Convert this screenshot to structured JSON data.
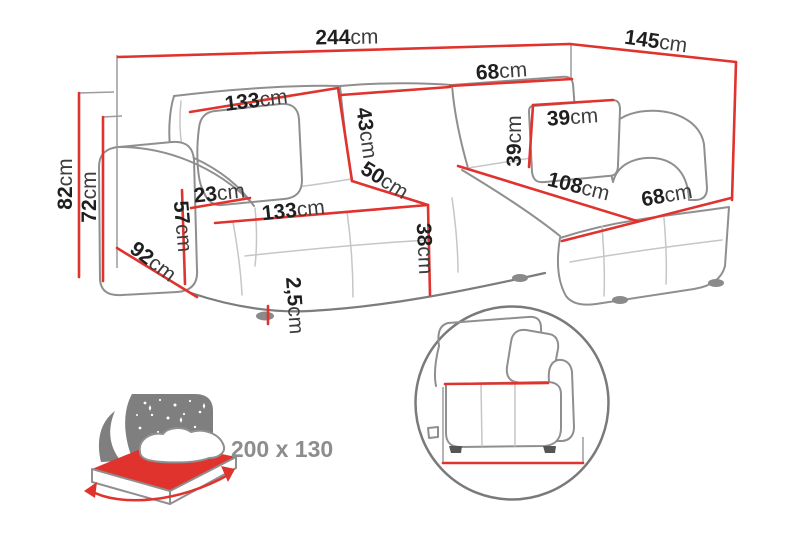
{
  "title": "Corner sofa dimensions diagram",
  "colors": {
    "accent": "#e0332e",
    "outline": "#8f8f8f",
    "outline_dark": "#7a7a7a",
    "text": "#1f1f1f",
    "unit_text": "#3d3d3d",
    "muted_text": "#8d8d8d",
    "star_panel": "#7f7f7f"
  },
  "measurements": {
    "w244": {
      "value": "244",
      "unit": "cm"
    },
    "d145": {
      "value": "145",
      "unit": "cm"
    },
    "b68": {
      "value": "68",
      "unit": "cm"
    },
    "b133": {
      "value": "133",
      "unit": "cm"
    },
    "h43": {
      "value": "43",
      "unit": "cm"
    },
    "p39w": {
      "value": "39",
      "unit": "cm"
    },
    "p39h": {
      "value": "39",
      "unit": "cm"
    },
    "s50": {
      "value": "50",
      "unit": "cm"
    },
    "c108": {
      "value": "108",
      "unit": "cm"
    },
    "c68": {
      "value": "68",
      "unit": "cm"
    },
    "a23": {
      "value": "23",
      "unit": "cm"
    },
    "s133": {
      "value": "133",
      "unit": "cm"
    },
    "s38": {
      "value": "38",
      "unit": "cm"
    },
    "a57": {
      "value": "57",
      "unit": "cm"
    },
    "d92": {
      "value": "92",
      "unit": "cm"
    },
    "t82": {
      "value": "82",
      "unit": "cm"
    },
    "t72": {
      "value": "72",
      "unit": "cm"
    },
    "l25": {
      "value": "2,5",
      "unit": "cm"
    },
    "v68": {
      "value": "68",
      "unit": "cm"
    },
    "v91": {
      "value": "91",
      "unit": "cm"
    }
  },
  "sleeping": {
    "size_label": "200 x 130"
  }
}
